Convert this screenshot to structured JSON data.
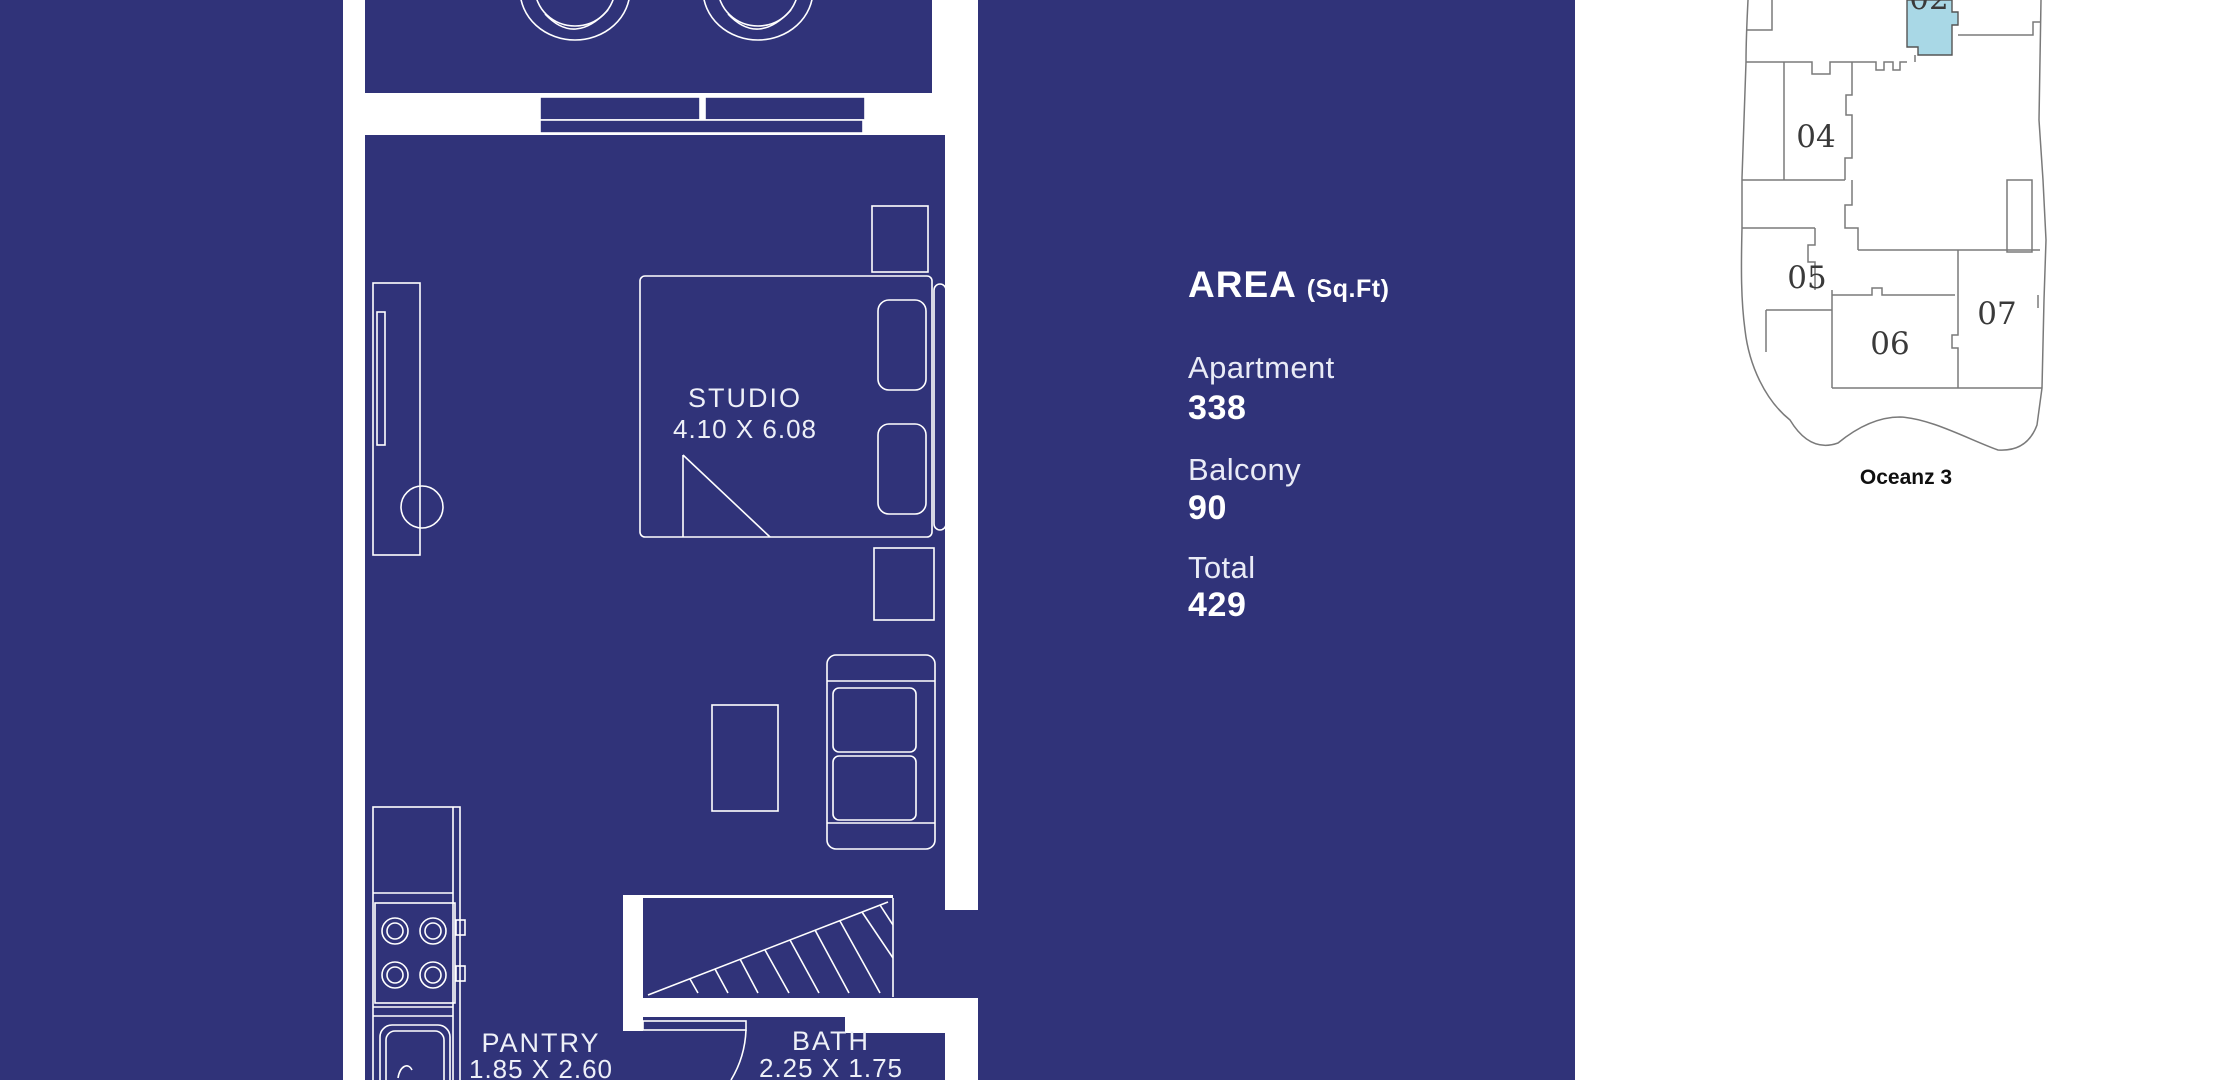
{
  "colors": {
    "navy_background": "#303379",
    "plan_lines": "#ffffff",
    "unit_highlight": "#a9d8e6",
    "keyplan_lines": "#7a7a7a",
    "keyplan_text": "#3a3a3a",
    "area_text": "#ffffff"
  },
  "floor_plan": {
    "studio": {
      "label": "STUDIO",
      "dimensions": "4.10 X 6.08"
    },
    "pantry": {
      "label": "PANTRY",
      "dimensions": "1.85 X 2.60"
    },
    "bath": {
      "label": "BATH",
      "dimensions": "2.25 X 1.75"
    }
  },
  "area_panel": {
    "title": "AREA",
    "unit": "(Sq.Ft)",
    "rows": [
      {
        "label": "Apartment",
        "value": "338"
      },
      {
        "label": "Balcony",
        "value": "90"
      },
      {
        "label": "Total",
        "value": "429"
      }
    ]
  },
  "key_plan": {
    "highlighted_unit": "02",
    "units": [
      {
        "label": "04"
      },
      {
        "label": "05"
      },
      {
        "label": "06"
      },
      {
        "label": "07"
      }
    ],
    "building_name": "Oceanz 3"
  }
}
